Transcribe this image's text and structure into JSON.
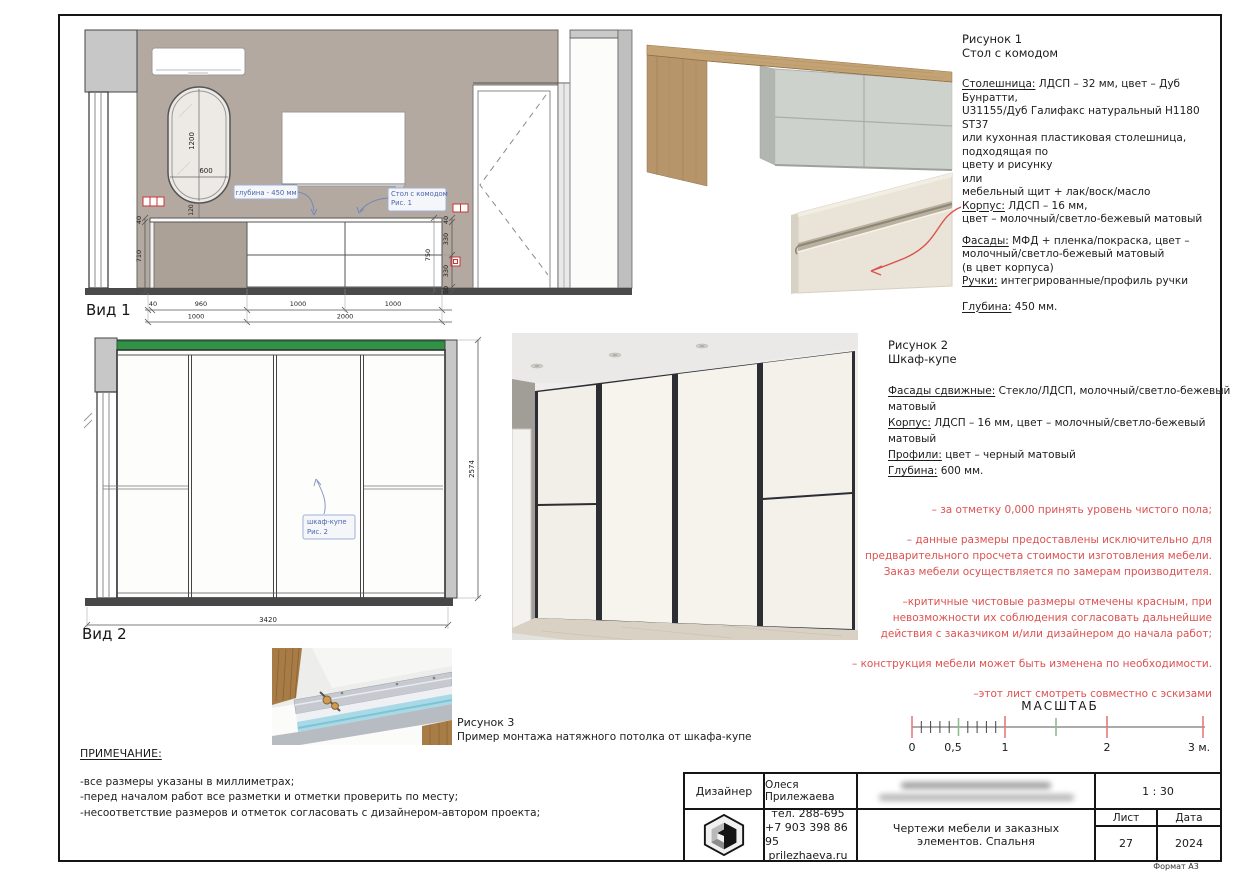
{
  "figure1": {
    "title": "Рисунок 1",
    "subtitle": "Стол с комодом",
    "lines": [
      {
        "u": "Столешница:",
        "t": " ЛДСП – 32 мм, цвет –  Дуб Бунратти,"
      },
      {
        "t": "U31155/Дуб Галифакс натуральный H1180 ST37"
      },
      {
        "t": "или кухонная пластиковая столешница, подходящая по"
      },
      {
        "t": "цвету и рисунку"
      },
      {
        "t": "или"
      },
      {
        "t": "мебельный щит + лак/воск/масло"
      },
      {
        "u": "Корпус:",
        "t": " ЛДСП – 16 мм,"
      },
      {
        "t": "цвет –  молочный/светло-бежевый матовый"
      },
      {
        "u": "Фасады:",
        "t": " МФД + пленка/покраска, цвет –"
      },
      {
        "t": "молочный/светло-бежевый матовый"
      },
      {
        "t": "(в цвет корпуса)"
      },
      {
        "u": "Ручки:",
        "t": " интегрированные/профиль ручки"
      },
      {
        "u": "Глубина:",
        "t": " 450 мм."
      }
    ]
  },
  "figure2": {
    "title": "Рисунок 2",
    "subtitle": "Шкаф-купе",
    "lines": [
      {
        "u": "Фасады сдвижные:",
        "t": " Стекло/ЛДСП, молочный/светло-бежевый матовый"
      },
      {
        "u": "Корпус:",
        "t": " ЛДСП – 16 мм, цвет –  молочный/светло-бежевый матовый"
      },
      {
        "u": "Профили:",
        "t": " цвет – черный матовый"
      },
      {
        "u": "Глубина:",
        "t": " 600 мм."
      }
    ]
  },
  "figure3": {
    "title": "Рисунок 3",
    "caption": "Пример монтажа натяжного потолка от шкафа-купе"
  },
  "views": {
    "view1": {
      "label": "Вид 1",
      "callouts": {
        "depth": "глубина - 450 мм",
        "table1": "Стол с комодом",
        "table2": "Рис. 1"
      },
      "dims": {
        "mirror_h": "1200",
        "mirror_w": "600",
        "mirror_gap": "120",
        "left": [
          "40",
          "710"
        ],
        "right": [
          "40",
          "330",
          "330",
          "50"
        ],
        "right_total": "750",
        "bottom1": [
          "40",
          "960",
          "1000",
          "1000"
        ],
        "bottom2": [
          "1000",
          "2000"
        ]
      }
    },
    "view2": {
      "label": "Вид 2",
      "callout": {
        "line1": "шкаф-купе",
        "line2": "Рис. 2"
      },
      "dims": {
        "width": "3420",
        "height": "2574"
      }
    }
  },
  "red_notes": {
    "items": [
      "– за отметку 0,000 принять уровень чистого пола;",
      "– данные размеры предоставлены исключительно для предварительного просчета стоимости изготовления мебели. Заказ мебели осуществляется по замерам производителя.",
      "–критичные чистовые размеры отмечены красным, при невозможности их соблюдения согласовать дальнейшие действия с заказчиком и/или дизайнером до начала работ;",
      "– конструкция мебели может быть изменена по необходимости.",
      "–этот лист смотреть совместно с эскизами"
    ]
  },
  "notes": {
    "title": "ПРИМЕЧАНИЕ:",
    "items": [
      "-все размеры указаны в миллиметрах;",
      "-перед началом работ все разметки и отметки проверить по месту;",
      "-несоответствие размеров и отметок согласовать с дизайнером-автором проекта;"
    ]
  },
  "scale_bar": {
    "title": "МАСШТАБ",
    "labels": [
      "0",
      "0,5",
      "1",
      "2",
      "3 м."
    ]
  },
  "titleblock": {
    "role": "Дизайнер",
    "designer": "Олеся Прилежаева",
    "scale": "1 : 30",
    "phone1": "тел. 288-695",
    "phone2": "+7 903 398 86 95",
    "site": "prilezhaeva.ru",
    "doc_title": "Чертежи мебели и заказных элементов. Спальня",
    "sheet_label": "Лист",
    "date_label": "Дата",
    "sheet_number": "27",
    "date": "2024",
    "format": "Формат А3"
  },
  "colors": {
    "wall": "#b3a9a0",
    "green_profile": "#2f9245",
    "callout_blue": "#4a66a8",
    "note_red": "#dd5252",
    "arrow_red": "#d9534f"
  }
}
